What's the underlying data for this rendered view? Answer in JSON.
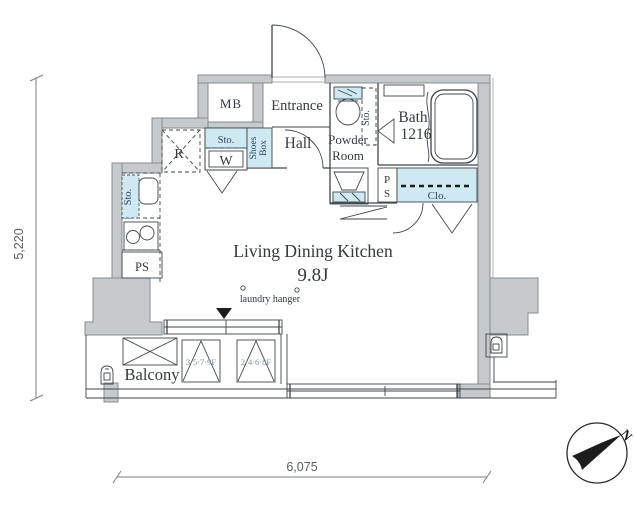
{
  "floorplan": {
    "rooms": {
      "ldk": "Living Dining Kitchen",
      "ldk_size": "9.8J",
      "entrance": "Entrance",
      "hall": "Hall",
      "powder_1": "Powder",
      "powder_2": "Room",
      "bath": "Bath",
      "bath_size": "1216",
      "closet": "Clo.",
      "balcony": "Balcony",
      "meter_box": "MB",
      "refrigerator": "R",
      "washer": "W",
      "shoes_1": "Shoes",
      "shoes_2": "Box",
      "storage_kitchen": "Sto.",
      "storage_hall": "Sto.",
      "storage_powder": "Sto.",
      "pipe_space_kitchen": "PS",
      "pipe_space_p": "P",
      "pipe_space_s": "S"
    },
    "annotations": {
      "laundry_hanger": "laundry hanger",
      "window_left_floors": "3·5·7·9F",
      "window_right_floors": "2·4·6·8F"
    },
    "dimensions": {
      "vertical": "5,220",
      "horizontal": "6,075"
    },
    "compass": {
      "north": "N"
    },
    "colors": {
      "wall_fill": "#c6cacd",
      "wall_stroke": "#878c90",
      "line": "#3f464b",
      "accent_fill": "#cfe9f2",
      "accent_text": "#2a4563",
      "text": "#333a40",
      "dim_text": "#595d5f",
      "floors_text": "#7d8f9b"
    }
  }
}
